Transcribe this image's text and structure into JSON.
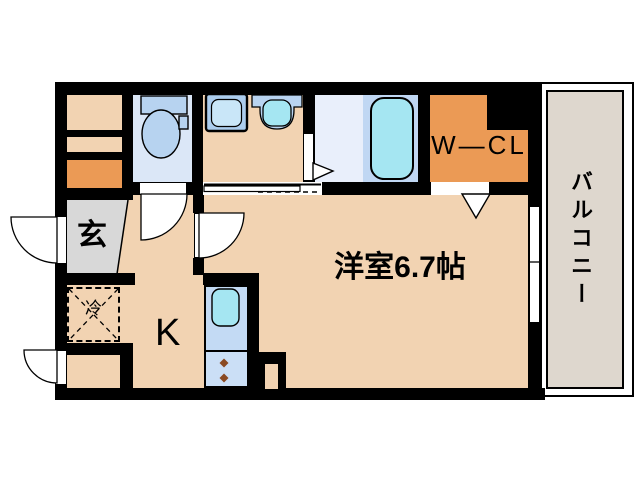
{
  "plan_title": "1K apartment floor plan",
  "labels": {
    "entrance": "玄",
    "kitchen": "K",
    "main_room": "洋室6.7帖",
    "walk_in_closet": "W—CL",
    "balcony": "バルコニー",
    "refrigerator_space": "冷"
  },
  "rooms": [
    {
      "name": "entrance",
      "label": "玄"
    },
    {
      "name": "kitchen",
      "label": "K"
    },
    {
      "name": "western-room",
      "label": "洋室6.7帖",
      "size_jo": "6.7"
    },
    {
      "name": "walk-in-closet",
      "label": "W—CL"
    },
    {
      "name": "balcony",
      "label": "バルコニー"
    },
    {
      "name": "toilet",
      "label": ""
    },
    {
      "name": "washroom",
      "label": ""
    },
    {
      "name": "bathroom",
      "label": ""
    }
  ],
  "icons": {
    "toilet": "toilet-icon",
    "washing_machine_pan": "washing-machine-pan-icon",
    "washbasin": "washbasin-icon",
    "bathtub": "bathtub-icon",
    "kitchen_sink": "kitchen-sink-icon",
    "stove_burners": "stove-burners-icon",
    "refrigerator_space": "refrigerator-space-icon",
    "door_swings": "door-swing-arc-icon",
    "open_doorway_arrows": "doorway-triangle-icon"
  },
  "colors": {
    "wall": "#000000",
    "room_beige": "#f2d3b2",
    "closet_orange": "#eb9a55",
    "entrance_gray": "#d8d8d8",
    "balcony_gray": "#ded7ce",
    "toilet_floor_blue": "#dbe7f7",
    "bathroom_floor_blue": "#e9effb",
    "fixture_blue": "#b7d3f0",
    "water_cyan": "#a5e6f2",
    "kitchen_unit_blue": "#c3daf4",
    "burner_brown": "#8a4a22"
  }
}
